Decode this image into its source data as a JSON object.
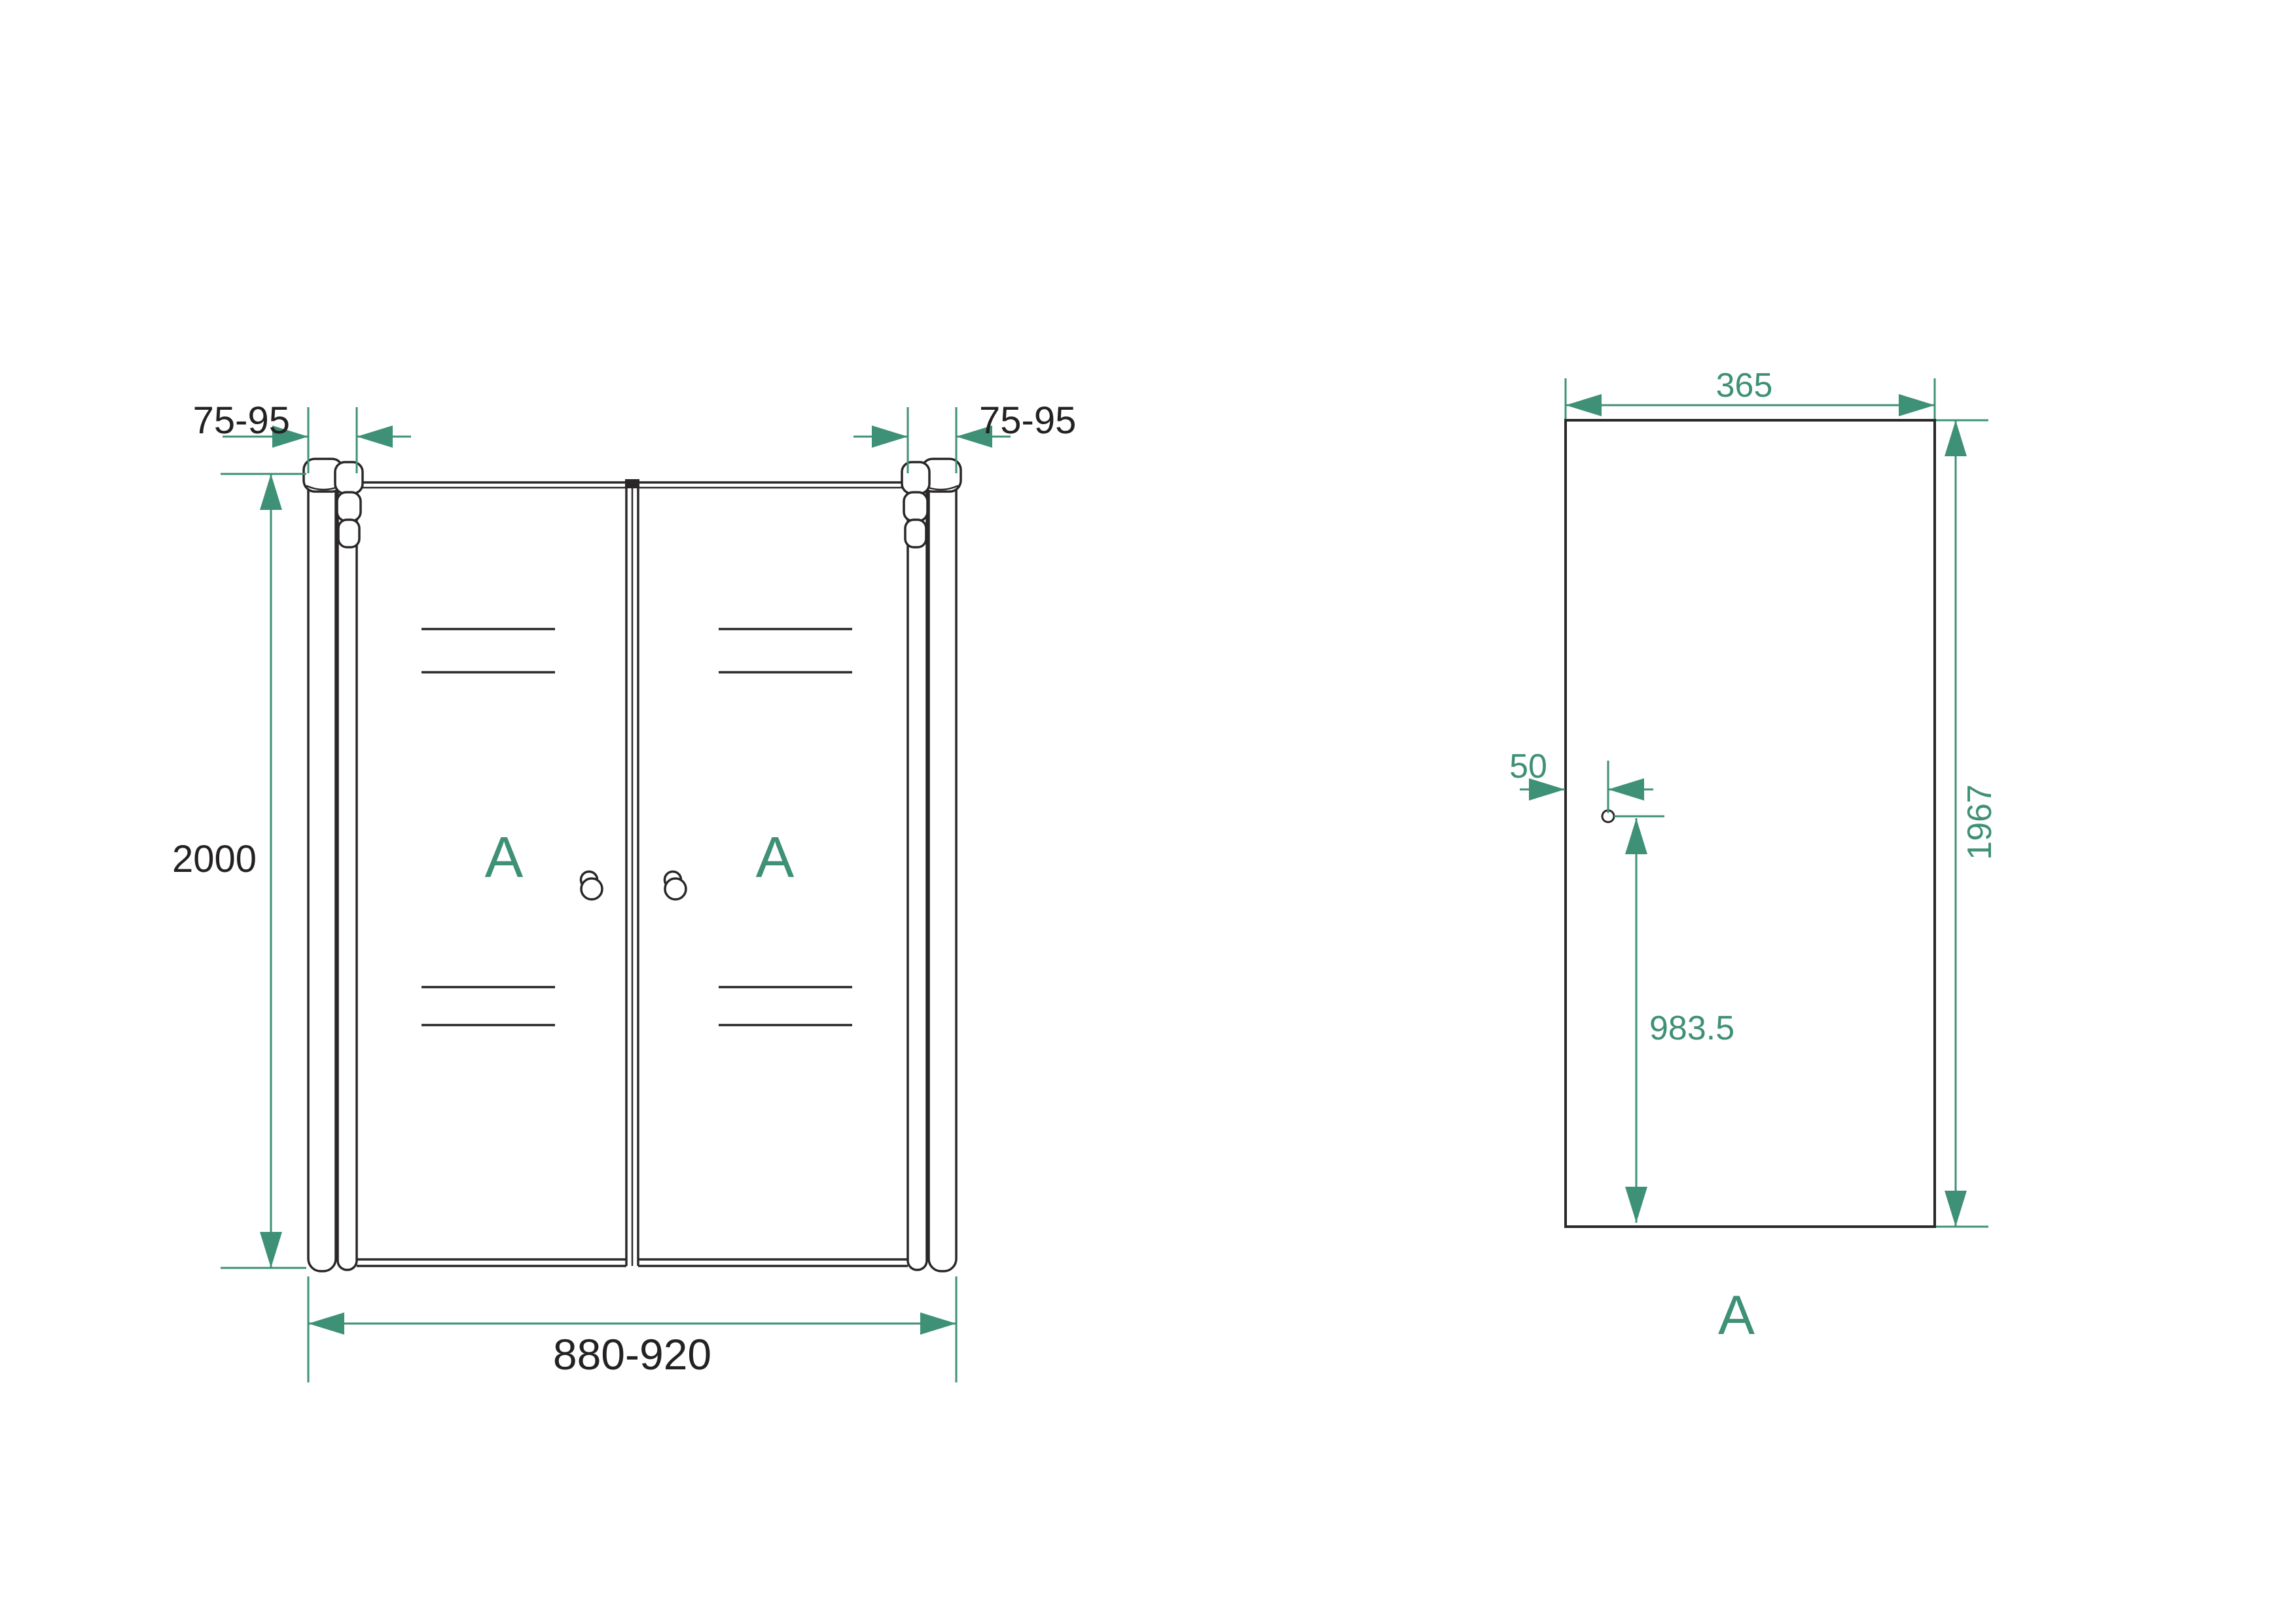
{
  "drawing": {
    "title": "double swing shower door technical drawing",
    "colors": {
      "accent": "#3e9076",
      "line": "#2a2728",
      "background": "#ffffff"
    }
  },
  "front_view": {
    "dim_wall_profile_left": "75-95",
    "dim_wall_profile_right": "75-95",
    "dim_height": "2000",
    "dim_width": "880-920",
    "door_left_label": "A",
    "door_right_label": "A"
  },
  "panel_view": {
    "dim_width": "365",
    "dim_height": "1967",
    "dim_hole_offset": "50",
    "dim_hole_from_bottom": "983.5",
    "panel_label": "A"
  }
}
